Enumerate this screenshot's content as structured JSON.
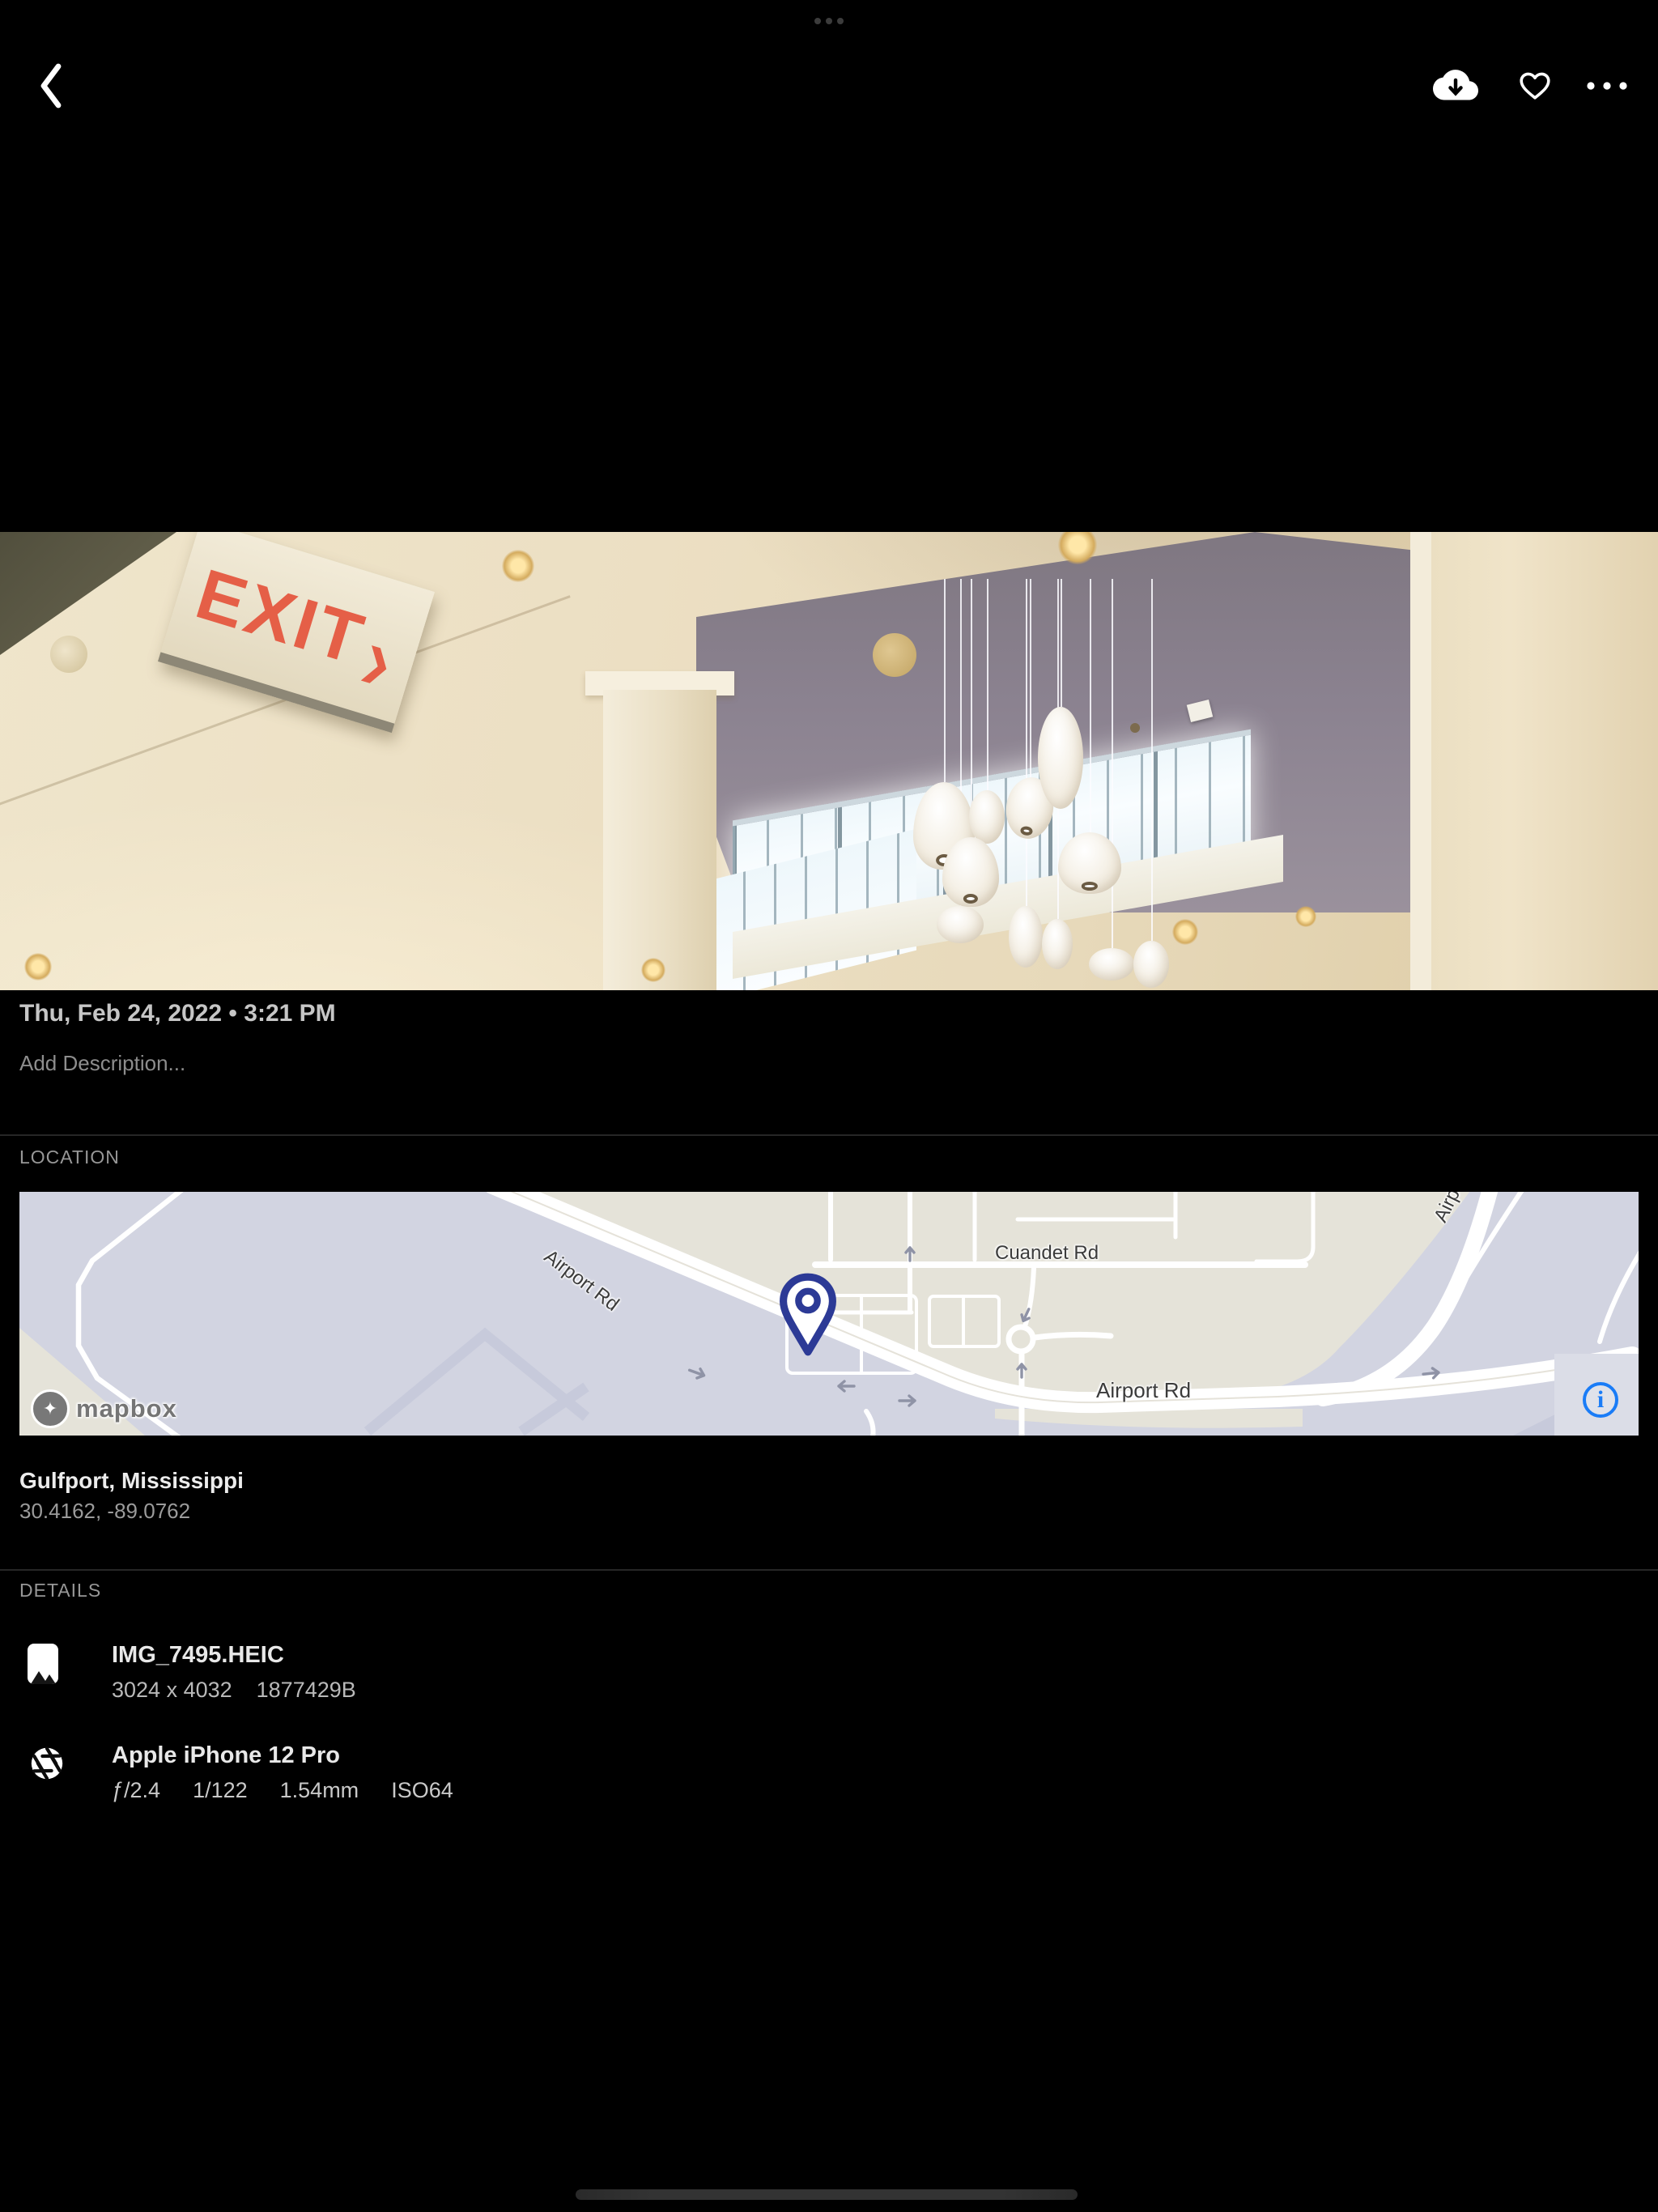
{
  "topbar": {
    "back_icon": "chevron-left",
    "download_icon": "cloud-download",
    "favorite_icon": "heart-outline",
    "more_icon": "ellipsis-horizontal"
  },
  "photo": {
    "exit_sign_text": "EXIT",
    "exit_sign_arrow": "❯"
  },
  "meta": {
    "datetime": "Thu, Feb 24, 2022 • 3:21 PM",
    "description_placeholder": "Add Description..."
  },
  "location": {
    "section_label": "LOCATION",
    "place": "Gulfport, Mississippi",
    "coordinates": "30.4162, -89.0762",
    "map": {
      "labels": {
        "airport_rd_diagonal": "Airport Rd",
        "airport_rd_horizontal": "Airport Rd",
        "cuandet_rd": "Cuandet Rd",
        "airport_rd_clipped": "Airpo",
        "clipped_road": "C"
      },
      "logo_text": "mapbox",
      "info_icon": "i",
      "colors": {
        "land_beige": "#e5e3d9",
        "field_lavender": "#d2d4e1",
        "accent_lavender": "#c7cadb",
        "road_white": "#ffffff",
        "pin_blue": "#2c3a96",
        "info_blue": "#1a7cf7"
      }
    }
  },
  "details": {
    "section_label": "DETAILS",
    "file": {
      "name": "IMG_7495.HEIC",
      "dimensions": "3024 x 4032",
      "size": "1877429B"
    },
    "camera": {
      "name": "Apple iPhone 12 Pro",
      "exif": [
        "ƒ/2.4",
        "1/122",
        "1.54mm",
        "ISO64"
      ]
    }
  }
}
